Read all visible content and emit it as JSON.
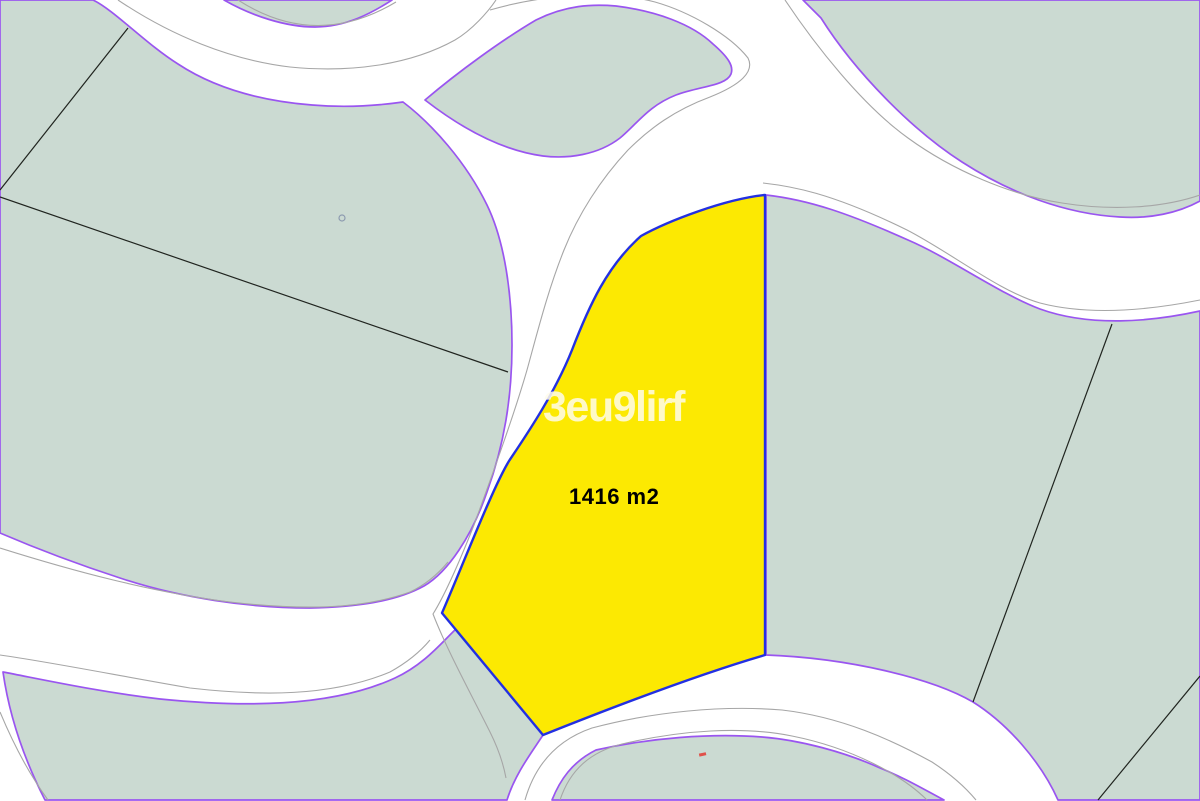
{
  "map": {
    "selected_parcel": {
      "area_label": "1416 m2"
    },
    "watermark_text": "3eu9lirf",
    "legend_semantics": {
      "white_regions": "roads",
      "green_regions": "cadastral parcels",
      "purple_lines": "parcel-road boundaries",
      "gray_lines": "road inner lines",
      "black_lines": "lot boundaries",
      "blue_outline": "selected parcel border"
    }
  },
  "colors": {
    "parcel_green": "#cbdad2",
    "road_white": "#ffffff",
    "boundary_purple": "#9a55f0",
    "road_inner_gray": "#a6a6a6",
    "lot_line_black": "#20241f",
    "selected_yellow": "#fce902",
    "selected_border_blue": "#2330e1",
    "watermark": "#fffceb",
    "area_text": "#000000",
    "red_mark": "#e0514a",
    "circle_marker": "#8d9bb0"
  }
}
